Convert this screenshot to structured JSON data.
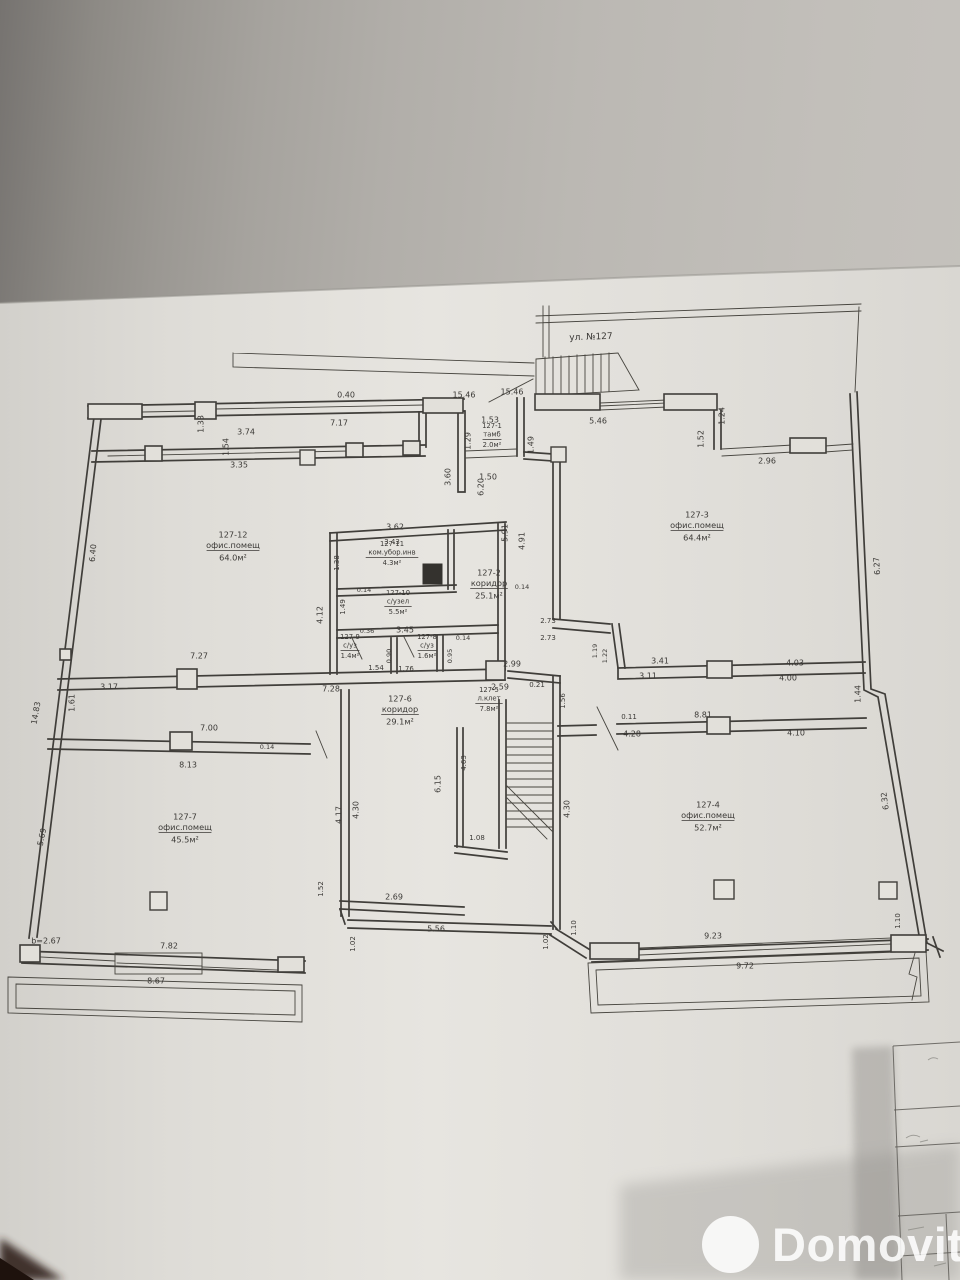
{
  "photo": {
    "paper_color": "#e3e1dc",
    "background_color": "#a6a39e",
    "line_color": "#403e3a"
  },
  "watermark": {
    "text": "Domovita"
  },
  "plan": {
    "street_label": "ул. №127",
    "height_note": "b=2.67",
    "rooms": [
      {
        "id": "127-1",
        "name": "тамб",
        "area": "2.0м²",
        "x": 492,
        "y": 426,
        "sm": 1
      },
      {
        "id": "127-2",
        "name": "коридор",
        "area": "25.1м²",
        "x": 489,
        "y": 573
      },
      {
        "id": "127-3",
        "name": "офис.помещ",
        "area": "64.4м²",
        "x": 697,
        "y": 515
      },
      {
        "id": "127-4",
        "name": "офис.помещ",
        "area": "52.7м²",
        "x": 708,
        "y": 805
      },
      {
        "id": "127-5",
        "name": "л.клет",
        "area": "7.8м²",
        "x": 489,
        "y": 690,
        "sm": 1
      },
      {
        "id": "127-6",
        "name": "коридор",
        "area": "29.1м²",
        "x": 400,
        "y": 699
      },
      {
        "id": "127-7",
        "name": "офис.помещ",
        "area": "45.5м²",
        "x": 185,
        "y": 817
      },
      {
        "id": "127-8",
        "name": "с/уз",
        "area": "1.6м²",
        "x": 427,
        "y": 637,
        "sm": 1
      },
      {
        "id": "127-9",
        "name": "с/уз",
        "area": "1.4м²",
        "x": 350,
        "y": 637,
        "sm": 1
      },
      {
        "id": "127-10",
        "name": "с/узел",
        "area": "5.5м²",
        "x": 398,
        "y": 593,
        "sm": 1
      },
      {
        "id": "127-11",
        "name": "ком.убор.инв",
        "area": "4.3м²",
        "x": 392,
        "y": 544,
        "sm": 1
      },
      {
        "id": "127-12",
        "name": "офис.помещ",
        "area": "64.0м²",
        "x": 233,
        "y": 535
      }
    ],
    "dimensions": [
      {
        "t": "3.74",
        "x": 246,
        "y": 432
      },
      {
        "t": "3.35",
        "x": 239,
        "y": 465
      },
      {
        "t": "1.33",
        "x": 201,
        "y": 424,
        "r": -90
      },
      {
        "t": "1.54",
        "x": 226,
        "y": 447,
        "r": -90
      },
      {
        "t": "0.40",
        "x": 346,
        "y": 395
      },
      {
        "t": "7.17",
        "x": 339,
        "y": 423
      },
      {
        "t": "15.46",
        "x": 464,
        "y": 395
      },
      {
        "t": "15.46",
        "x": 512,
        "y": 392
      },
      {
        "t": "5.46",
        "x": 598,
        "y": 421
      },
      {
        "t": "1.53",
        "x": 490,
        "y": 420
      },
      {
        "t": "1.29",
        "x": 468,
        "y": 441,
        "r": -90
      },
      {
        "t": "1.49",
        "x": 531,
        "y": 445,
        "r": -90
      },
      {
        "t": "1.50",
        "x": 488,
        "y": 477
      },
      {
        "t": "3.60",
        "x": 448,
        "y": 477,
        "r": -90
      },
      {
        "t": "1.24",
        "x": 722,
        "y": 416,
        "r": -90
      },
      {
        "t": "1.52",
        "x": 701,
        "y": 439,
        "r": -90
      },
      {
        "t": "2.96",
        "x": 767,
        "y": 461
      },
      {
        "t": "6.27",
        "x": 877,
        "y": 566,
        "r": -94
      },
      {
        "t": "1.44",
        "x": 858,
        "y": 694,
        "r": -90
      },
      {
        "t": "6.32",
        "x": 885,
        "y": 801,
        "r": -98
      },
      {
        "t": "1.10",
        "x": 898,
        "y": 921,
        "r": -90,
        "s": 7
      },
      {
        "t": "6.40",
        "x": 93,
        "y": 553,
        "r": -85
      },
      {
        "t": "14.83",
        "x": 36,
        "y": 713,
        "r": -80
      },
      {
        "t": "5.69",
        "x": 42,
        "y": 837,
        "r": -78
      },
      {
        "t": "1.61",
        "x": 72,
        "y": 703,
        "r": -90
      },
      {
        "t": "7.27",
        "x": 199,
        "y": 656
      },
      {
        "t": "3.17",
        "x": 109,
        "y": 687
      },
      {
        "t": "7.28",
        "x": 331,
        "y": 689
      },
      {
        "t": "3.62",
        "x": 395,
        "y": 527
      },
      {
        "t": "3.43",
        "x": 392,
        "y": 542,
        "s": 7
      },
      {
        "t": "1.38",
        "x": 337,
        "y": 563,
        "r": -90,
        "s": 7
      },
      {
        "t": "0.14",
        "x": 364,
        "y": 590,
        "s": 6.5
      },
      {
        "t": "4.12",
        "x": 320,
        "y": 615,
        "r": -90
      },
      {
        "t": "1.49",
        "x": 343,
        "y": 607,
        "r": -90,
        "s": 7
      },
      {
        "t": "0.36",
        "x": 367,
        "y": 631,
        "s": 6.5
      },
      {
        "t": "3.45",
        "x": 405,
        "y": 630
      },
      {
        "t": "0.14",
        "x": 463,
        "y": 638,
        "s": 6.5
      },
      {
        "t": "0.90",
        "x": 389,
        "y": 656,
        "r": -90,
        "s": 6.5
      },
      {
        "t": "0.95",
        "x": 450,
        "y": 656,
        "r": -90,
        "s": 6.5
      },
      {
        "t": "1.54",
        "x": 376,
        "y": 668,
        "s": 7
      },
      {
        "t": "1.76",
        "x": 406,
        "y": 669,
        "s": 7
      },
      {
        "t": "5.91",
        "x": 505,
        "y": 533,
        "r": -90
      },
      {
        "t": "4.91",
        "x": 522,
        "y": 541,
        "r": -90
      },
      {
        "t": "6.20",
        "x": 481,
        "y": 487,
        "r": -90
      },
      {
        "t": "0.14",
        "x": 522,
        "y": 587,
        "s": 6.5
      },
      {
        "t": "2.73",
        "x": 548,
        "y": 621,
        "s": 7
      },
      {
        "t": "2.73",
        "x": 548,
        "y": 638,
        "s": 7
      },
      {
        "t": "1.19",
        "x": 595,
        "y": 651,
        "r": -90,
        "s": 6.5
      },
      {
        "t": "1.22",
        "x": 605,
        "y": 656,
        "r": -90,
        "s": 6.5
      },
      {
        "t": "2.99",
        "x": 512,
        "y": 664
      },
      {
        "t": "2.59",
        "x": 500,
        "y": 687
      },
      {
        "t": "0.21",
        "x": 537,
        "y": 685,
        "s": 7
      },
      {
        "t": "1.56",
        "x": 563,
        "y": 701,
        "r": -90,
        "s": 7
      },
      {
        "t": "4.30",
        "x": 567,
        "y": 809,
        "r": -90
      },
      {
        "t": "4.63",
        "x": 464,
        "y": 763,
        "r": -90,
        "s": 7
      },
      {
        "t": "6.15",
        "x": 438,
        "y": 784,
        "r": -90
      },
      {
        "t": "1.08",
        "x": 477,
        "y": 838,
        "s": 7
      },
      {
        "t": "3.41",
        "x": 660,
        "y": 661
      },
      {
        "t": "3.11",
        "x": 648,
        "y": 676
      },
      {
        "t": "4.03",
        "x": 795,
        "y": 663
      },
      {
        "t": "4.00",
        "x": 788,
        "y": 678
      },
      {
        "t": "0.11",
        "x": 629,
        "y": 717,
        "s": 7
      },
      {
        "t": "8.81",
        "x": 703,
        "y": 715
      },
      {
        "t": "4.28",
        "x": 632,
        "y": 734
      },
      {
        "t": "4.10",
        "x": 796,
        "y": 733
      },
      {
        "t": "7.00",
        "x": 209,
        "y": 728
      },
      {
        "t": "0.14",
        "x": 267,
        "y": 747,
        "s": 6.5
      },
      {
        "t": "8.13",
        "x": 188,
        "y": 765
      },
      {
        "t": "4.17",
        "x": 339,
        "y": 815,
        "r": -90
      },
      {
        "t": "4.30",
        "x": 356,
        "y": 810,
        "r": -90
      },
      {
        "t": "1.52",
        "x": 321,
        "y": 889,
        "r": -90,
        "s": 7
      },
      {
        "t": "7.82",
        "x": 169,
        "y": 946
      },
      {
        "t": "8.67",
        "x": 156,
        "y": 981
      },
      {
        "t": "2.69",
        "x": 394,
        "y": 897
      },
      {
        "t": "5.56",
        "x": 436,
        "y": 929
      },
      {
        "t": "1.02",
        "x": 353,
        "y": 944,
        "r": -90,
        "s": 7
      },
      {
        "t": "1.02",
        "x": 546,
        "y": 942,
        "r": -90,
        "s": 7
      },
      {
        "t": "1.10",
        "x": 574,
        "y": 928,
        "r": -90,
        "s": 7
      },
      {
        "t": "9.23",
        "x": 713,
        "y": 936
      },
      {
        "t": "9.72",
        "x": 745,
        "y": 966
      }
    ]
  }
}
